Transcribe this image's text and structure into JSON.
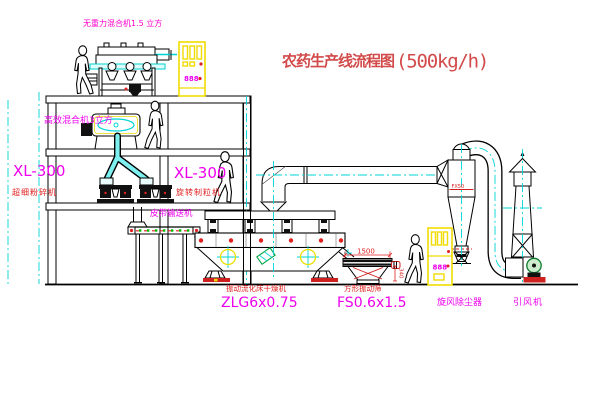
{
  "title": {
    "name": "农药生产线流程图",
    "capacity": "(500kg/h)"
  },
  "equipment_labels": {
    "top_mixer": "无重力混合机1.5 立方",
    "second_mixer": "高效混合机3立方",
    "mill_model": "XL-300",
    "mill_name": "超细粉碎机",
    "granulator_model": "XL-300",
    "granulator_name": "旋转制粒机",
    "belt_conveyor": "皮带输送机",
    "dryer_name": "振动流化床干燥机",
    "dryer_model": "ZLG6x0.75",
    "screen_name": "方形振动筛",
    "screen_model": "FS0.6x1.5",
    "cyclone_name": "旋风除尘器",
    "cyclone_mark": "FX50",
    "fan_name": "引风机"
  },
  "dimensions": {
    "screen_length": "1500",
    "screen_outlet_height": "340"
  },
  "control_cabinets": {
    "top_display": "888",
    "ground_display": "888"
  },
  "colors": {
    "title_red": "#d24a4a",
    "label_red": "#e02020",
    "label_magenta": "#ee00ee",
    "label_pink": "#ff00cc",
    "centerline_cyan": "#00d5d5",
    "cabinet_yellow": "#f0dc00",
    "conveyor_green": "#00bb00",
    "line_black": "#000000"
  }
}
